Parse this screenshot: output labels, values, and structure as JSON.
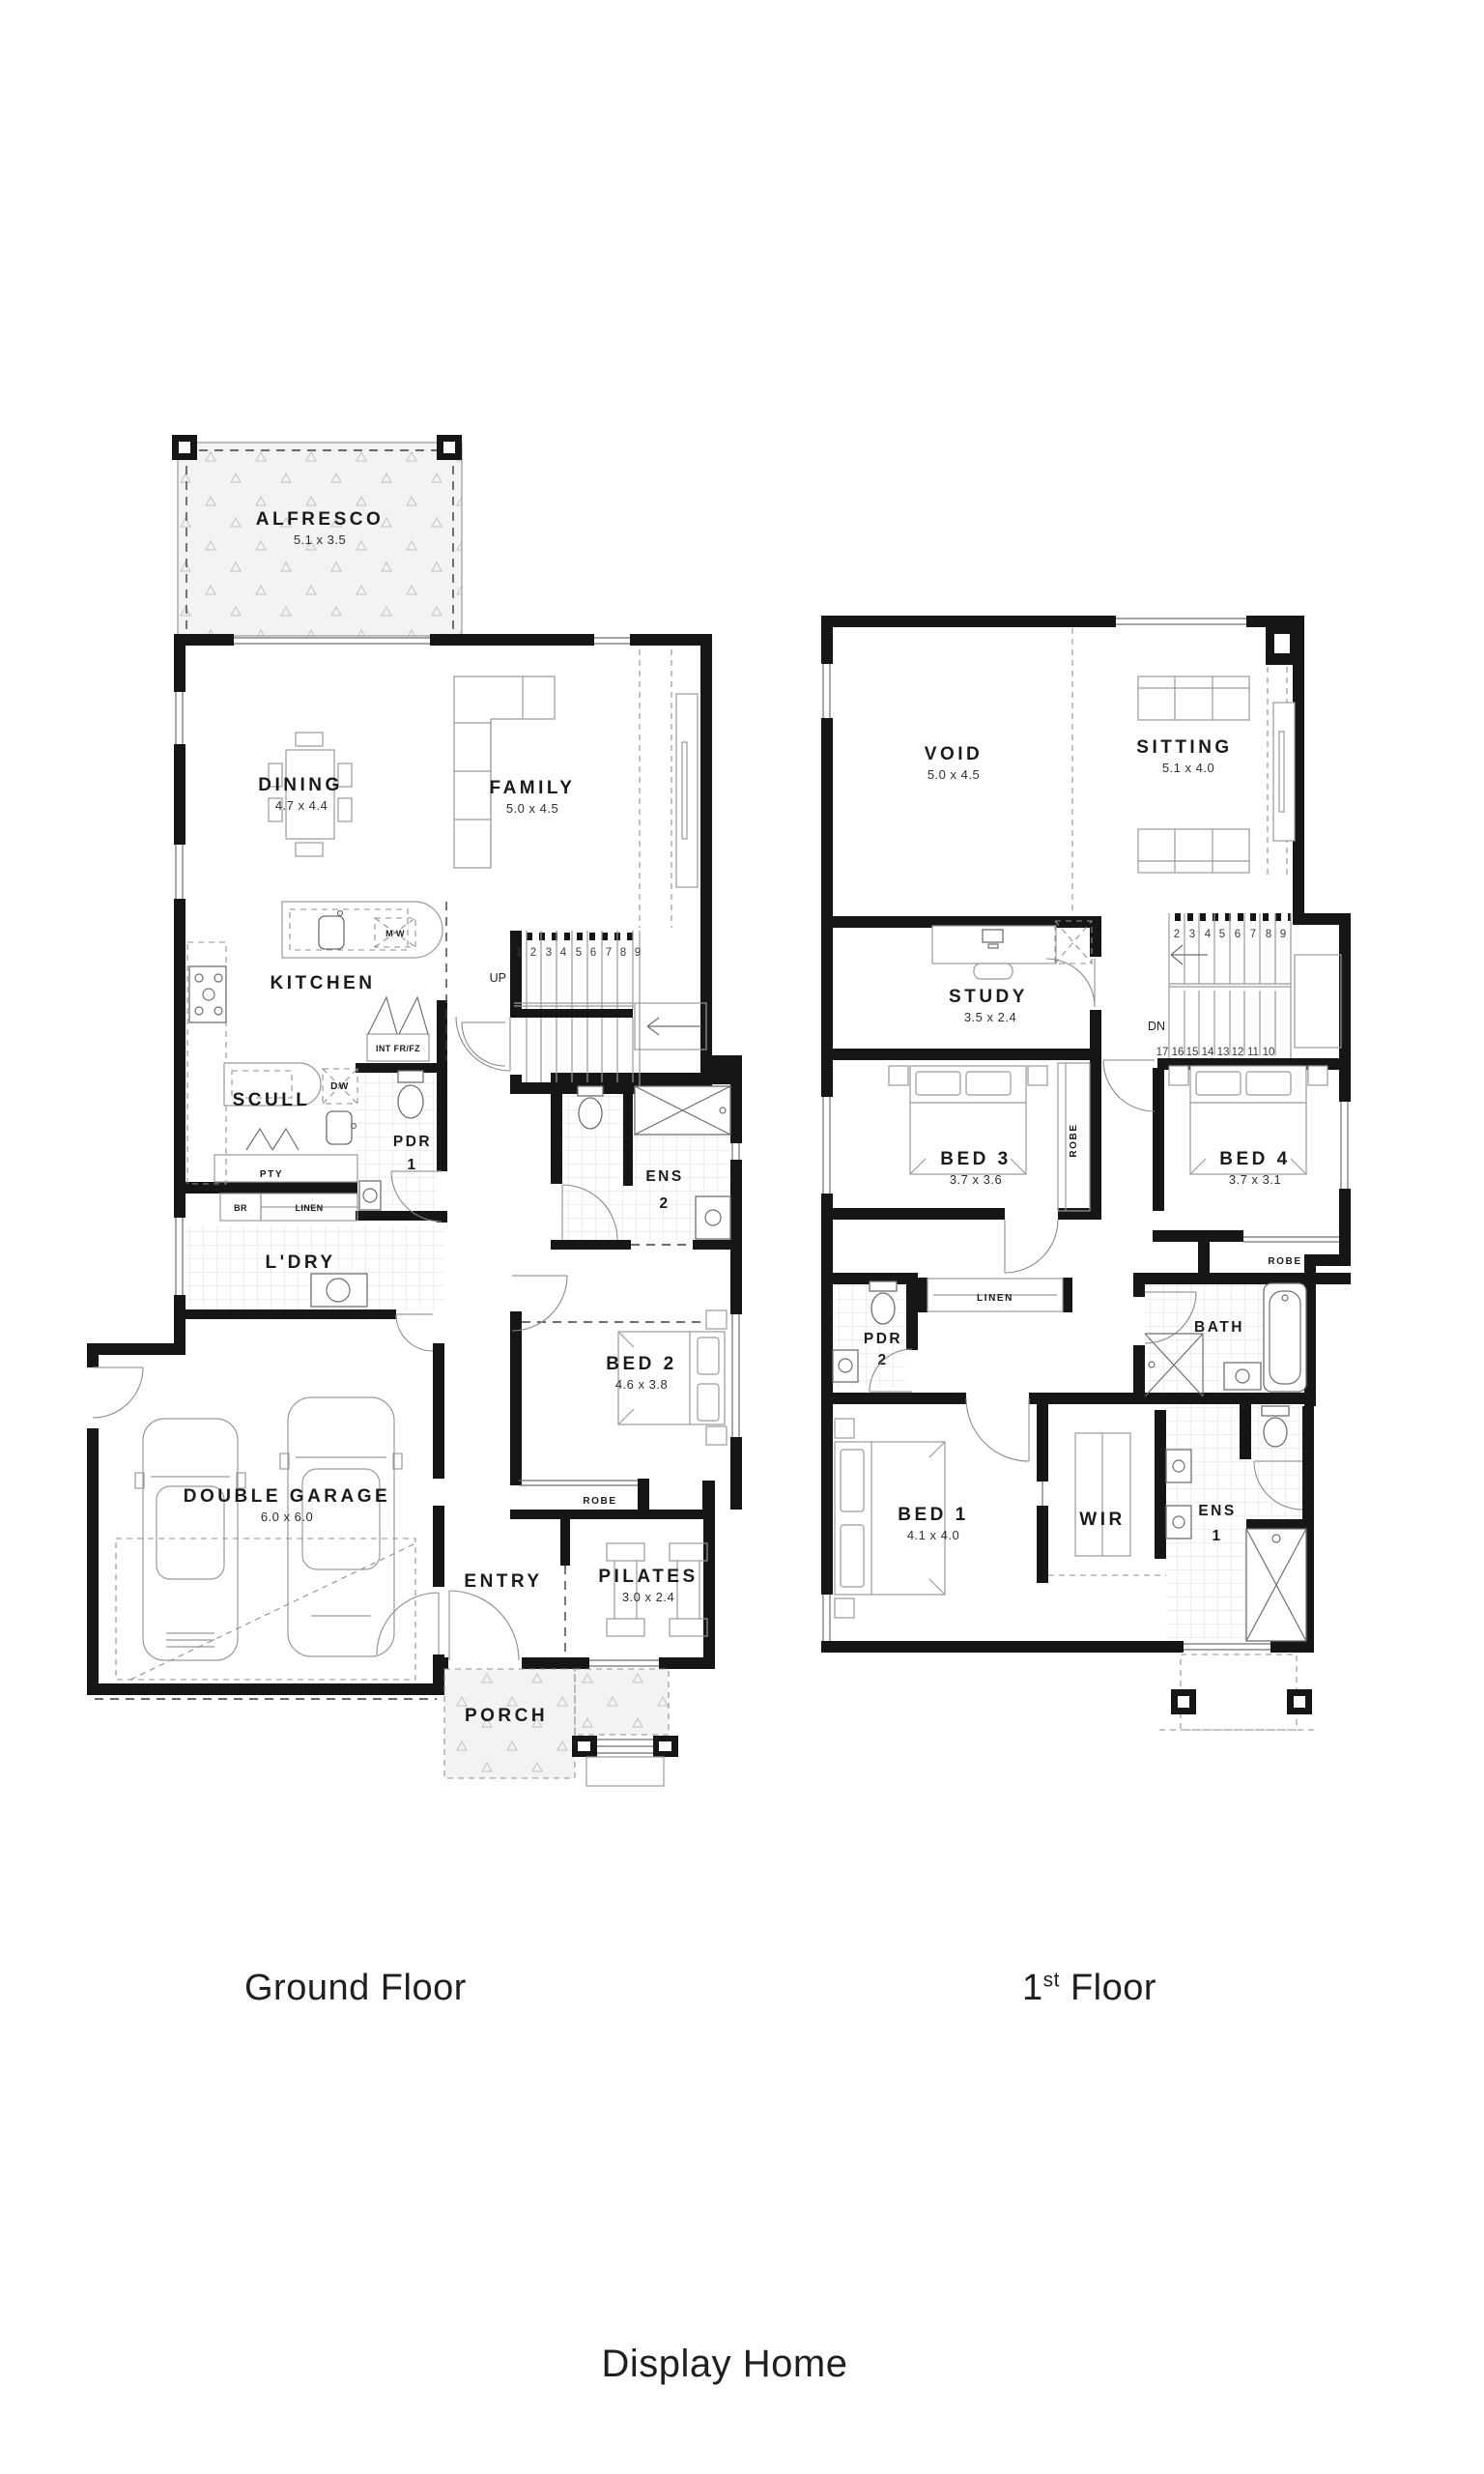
{
  "page": {
    "title": "Display Home"
  },
  "captions": {
    "ground": "Ground Floor",
    "first_num": "1",
    "first_sup": "st",
    "first_rest": "Floor"
  },
  "ground": {
    "alfresco": {
      "label": "ALFRESCO",
      "dim": "5.1 x 3.5"
    },
    "dining": {
      "label": "DINING",
      "dim": "4.7 x 4.4"
    },
    "family": {
      "label": "FAMILY",
      "dim": "5.0 x 4.5"
    },
    "kitchen": {
      "label": "KITCHEN"
    },
    "scull": {
      "label": "SCULL"
    },
    "ldry": {
      "label": "L'DRY"
    },
    "pdr1": {
      "label": "PDR",
      "num": "1"
    },
    "ens2": {
      "label": "ENS",
      "num": "2"
    },
    "bed2": {
      "label": "BED 2",
      "dim": "4.6 x 3.8"
    },
    "garage": {
      "label": "DOUBLE GARAGE",
      "dim": "6.0 x 6.0"
    },
    "entry": {
      "label": "ENTRY"
    },
    "pilates": {
      "label": "PILATES",
      "dim": "3.0 x 2.4"
    },
    "porch": {
      "label": "PORCH"
    },
    "robe": {
      "label": "ROBE"
    },
    "fixtures": {
      "mw": "M W",
      "dw": "DW",
      "fridge": "INT FR/FZ",
      "pty": "PTY",
      "br": "BR",
      "linen": "LINEN"
    },
    "stairs": {
      "up": "UP",
      "treads": [
        "1",
        "2",
        "3",
        "4",
        "5",
        "6",
        "7",
        "8",
        "9"
      ]
    }
  },
  "first": {
    "void": {
      "label": "VOID",
      "dim": "5.0 x 4.5"
    },
    "sitting": {
      "label": "SITTING",
      "dim": "5.1 x 4.0"
    },
    "study": {
      "label": "STUDY",
      "dim": "3.5 x 2.4"
    },
    "bed3": {
      "label": "BED 3",
      "dim": "3.7 x 3.6"
    },
    "bed4": {
      "label": "BED 4",
      "dim": "3.7 x 3.1"
    },
    "bed1": {
      "label": "BED 1",
      "dim": "4.1 x 4.0"
    },
    "bath": {
      "label": "BATH"
    },
    "wir": {
      "label": "WIR"
    },
    "ens1": {
      "label": "ENS",
      "num": "1"
    },
    "pdr2": {
      "label": "PDR",
      "num": "2"
    },
    "linen": {
      "label": "LINEN"
    },
    "robe_bed3": {
      "label": "ROBE"
    },
    "robe_bed4": {
      "label": "ROBE"
    },
    "stairs": {
      "dn": "DN",
      "treads_top": [
        "2",
        "3",
        "4",
        "5",
        "6",
        "7",
        "8",
        "9"
      ],
      "treads_bottom": [
        "17",
        "16",
        "15",
        "14",
        "13",
        "12",
        "11",
        "10"
      ]
    }
  }
}
